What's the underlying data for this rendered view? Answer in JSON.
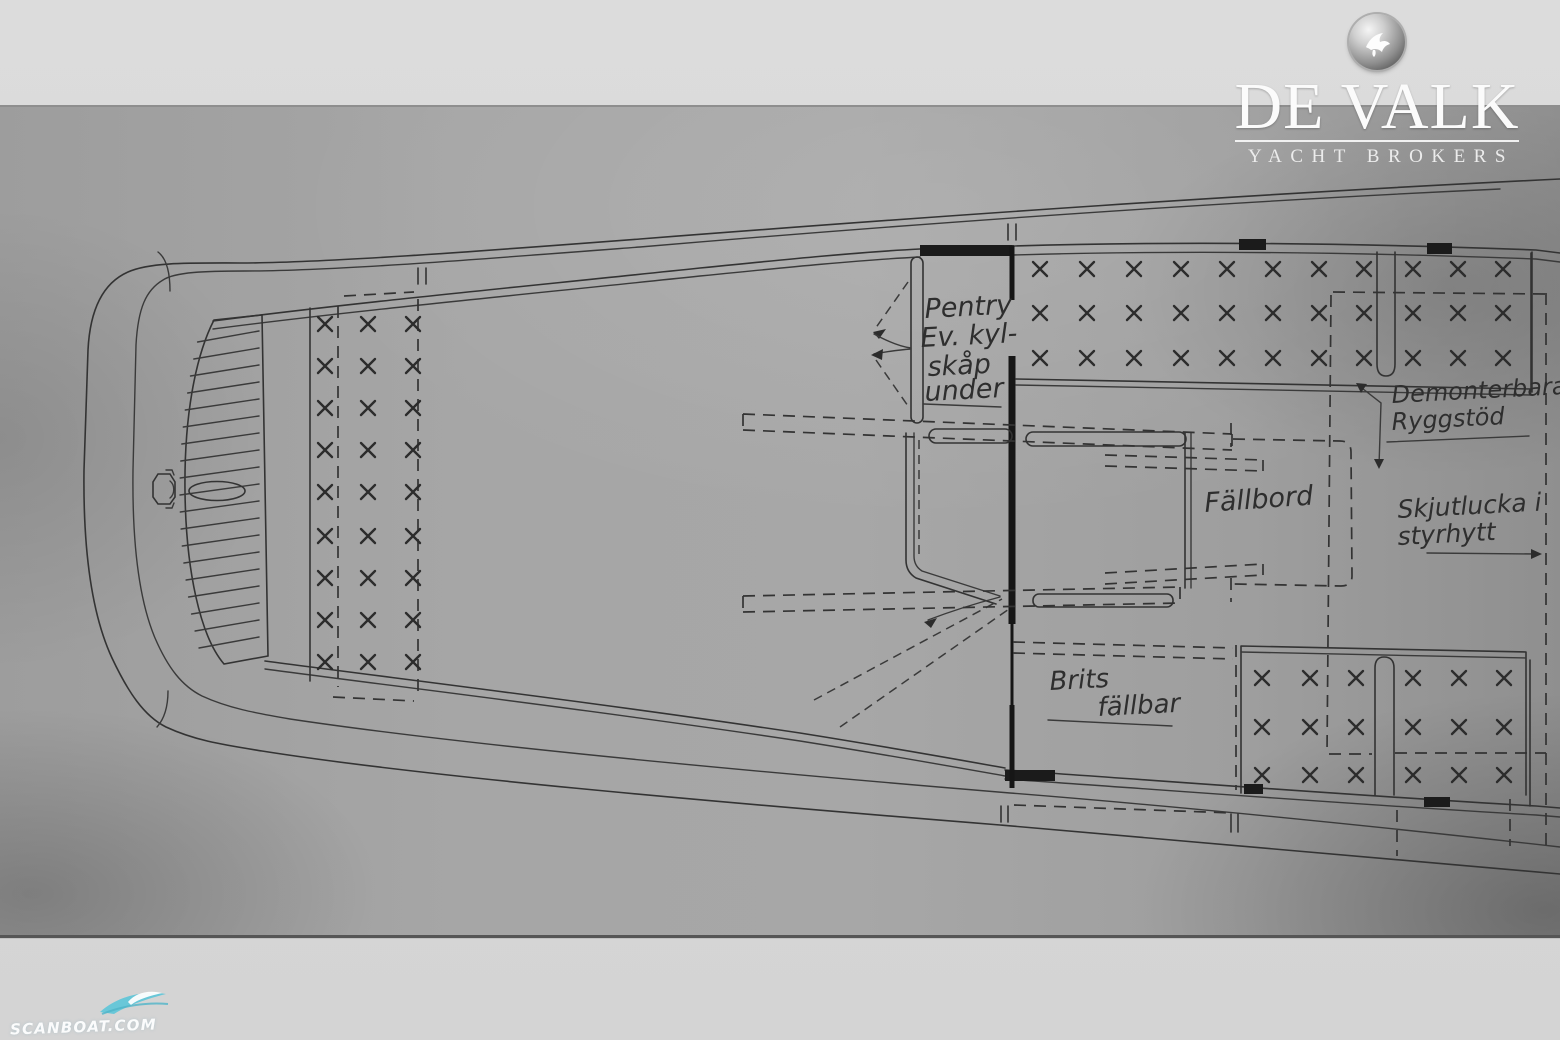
{
  "logo": {
    "title": "DE VALK",
    "subtitle": "YACHT BROKERS",
    "icon": "falcon-bird-icon"
  },
  "watermark": {
    "text": "SCANBOAT.COM",
    "icon": "wave-swoosh-icon",
    "accent_color": "#5fc6d8"
  },
  "drawing": {
    "type": "yacht deck layout plan, scanned pencil drawing",
    "ink_color": "#333333",
    "paper_color": "#a6a6a6",
    "page_color": "#d6d6d6",
    "annotations": {
      "pentry": {
        "lines": [
          "Pentry",
          "Ev. kyl-",
          "skåp",
          "under"
        ]
      },
      "fallbord": "Fällbord",
      "demonterbara": {
        "lines": [
          "Demonterbara",
          "Ryggstöd"
        ]
      },
      "skjutlucka": {
        "lines": [
          "Skjutlucka i",
          "styrhytt"
        ]
      },
      "brits": {
        "lines": [
          "Brits",
          "fällbar"
        ]
      }
    },
    "x_groups": [
      {
        "name": "fore-cabin-berth",
        "cols": [
          325,
          368,
          413
        ],
        "rows": [
          324,
          366,
          408,
          450,
          492,
          536,
          578,
          620,
          662
        ]
      },
      {
        "name": "wheelhouse-bench-top-left",
        "cols": [
          1040,
          1087,
          1134,
          1181,
          1227,
          1273,
          1319,
          1364
        ],
        "rows": [
          269,
          313,
          358
        ]
      },
      {
        "name": "wheelhouse-bench-top-right",
        "cols": [
          1413,
          1458,
          1503
        ],
        "rows": [
          269,
          313,
          358
        ]
      },
      {
        "name": "wheelhouse-bench-bottom-left",
        "cols": [
          1262,
          1310,
          1356
        ],
        "rows": [
          678,
          727,
          775
        ]
      },
      {
        "name": "wheelhouse-bench-bottom-right",
        "cols": [
          1413,
          1459,
          1504
        ],
        "rows": [
          678,
          727,
          775
        ]
      }
    ],
    "grating": {
      "count": 19,
      "y0": 342,
      "step": 17,
      "x_right": 259,
      "slant": -11
    }
  }
}
